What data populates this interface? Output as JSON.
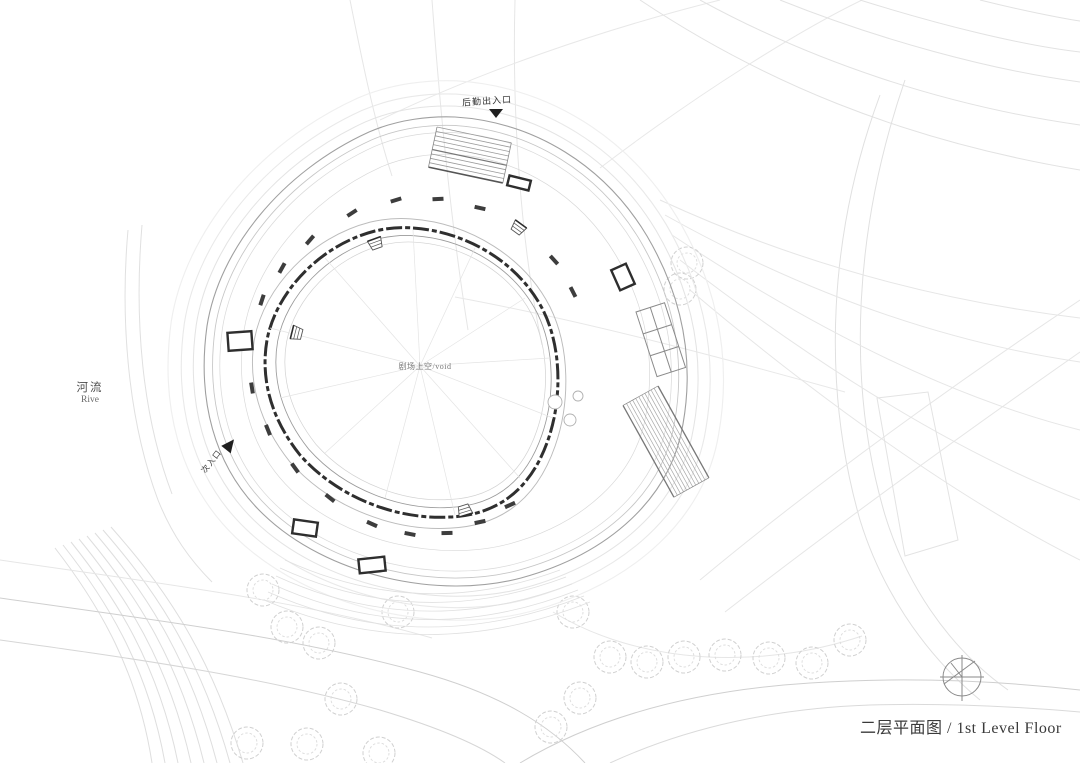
{
  "plan": {
    "title": "二层平面图 /  1st Level Floor",
    "labels": {
      "service_entrance": "后勤出入口",
      "secondary_entrance": "次入口",
      "river_zh": "河流",
      "river_en": "Rive",
      "central_void": "剧场上空/void"
    },
    "icons": {
      "service_entrance_arrow": "triangle-down-icon",
      "secondary_entrance_arrow": "triangle-ne-icon",
      "north_compass": "compass-icon"
    },
    "colors": {
      "wall_dark": "#2f2f2f",
      "building_line": "#9a9a9a",
      "landscape_line": "#dedede",
      "tree_line": "#d0d0d0",
      "text": "#3a3a3a"
    }
  }
}
